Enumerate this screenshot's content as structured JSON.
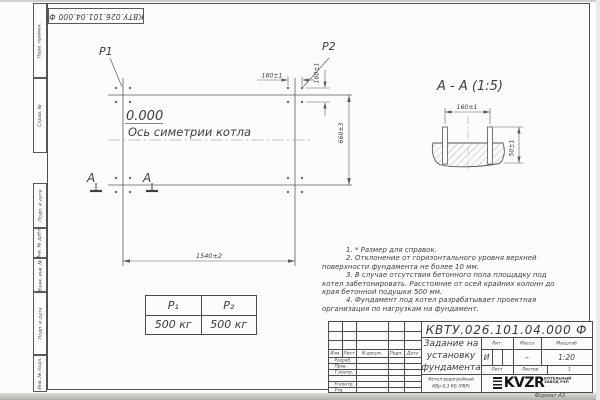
{
  "stamp_top": "КВТУ.026.101.04.000 Ф",
  "format_label": "Формат А3",
  "margin_labels": {
    "perv": "Перв. примен.",
    "sprav": "Справ. №",
    "podp1": "Подп. и дата",
    "inv_dubl": "Инв. № дубл.",
    "vzam": "Взам. инв. №",
    "podp2": "Подп. и дата",
    "inv_podl": "Инв. № подл."
  },
  "plan": {
    "p1": "Р1",
    "p2": "Р2",
    "level": "0.000",
    "axis_label": "Ось симетрии котла",
    "dim_160_top": "160±1",
    "dim_160_side": "160±1",
    "dim_660": "660±3",
    "dim_1540": "1540±2",
    "section_letter_left": "А",
    "section_letter_right": "А"
  },
  "section": {
    "title": "А - А (1:5)",
    "dim_160": "160±1",
    "dim_50": "50±1"
  },
  "load_table": {
    "headers": [
      "Р₁",
      "Р₂"
    ],
    "values": [
      "500 кг",
      "500 кг"
    ]
  },
  "notes": [
    "1. * Размер для справок.",
    "2. Отклонение от горизонтального уровня верхней поверхности фундамента не более 10 мм.",
    "3. В случае отсутствия бетонного пола площадку под котел забетонировать. Расстояние от осей крайних колонн до края бетонной подушки 500 мм.",
    "4. Фундамент под котел разрабатывает проектная организация по нагрузкам на фундамент."
  ],
  "titleblock": {
    "doc_number": "КВТУ.026.101.04.000  Ф",
    "title_lines": [
      "Задание на",
      "установку",
      "фундамента"
    ],
    "product_lines": [
      "Котел водогрейный",
      "КВр-0,3 КБ (РВР)"
    ],
    "header_cols": [
      "Изм.",
      "Лист",
      "N докум.",
      "Подп.",
      "Дата"
    ],
    "roles": [
      "Разраб.",
      "Пров.",
      "Т.контр.",
      "",
      "Н.контр.",
      "Утв."
    ],
    "lit_label": "Лит.",
    "mass_label": "Масса",
    "scale_label": "Масштаб",
    "lit_value": "И",
    "mass_value": "–",
    "scale_value": "1:20",
    "sheet_label": "Лист",
    "sheets_label": "Листов",
    "sheets_value": "1",
    "logo_text": "KVZR",
    "logo_sub1": "КОТЕЛЬНЫЙ",
    "logo_sub2": "ЗАВОД РЭП"
  }
}
